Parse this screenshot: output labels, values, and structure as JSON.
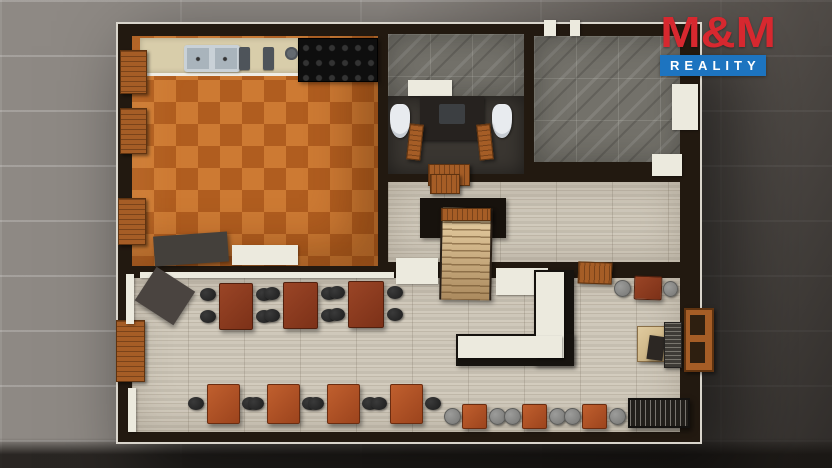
{
  "brand": {
    "name": "M&M",
    "tagline": "REALITY",
    "red": "#d7282f",
    "blue": "#1d74c0"
  },
  "scene": {
    "description": "3D top-down floor plan render of a restaurant: kitchen with orange tile, washrooms, marble storage room, hallway with staircase, dining room with bar",
    "palette": {
      "pavement": "#8e8984",
      "wall": "#221910",
      "kitchen_tile": "#c06c2a",
      "wood_floor": "#c9c2b3",
      "marble_floor": "#73716a",
      "wc_floor": "#3a3631",
      "counter_beige": "#d8cdaa",
      "table_wood": "#8c3c22",
      "table_orange": "#b4542a",
      "chair_dark": "#262525",
      "chair_gray": "#8f8f8d",
      "bar_top": "#eceade",
      "wood_shutter": "#a55d26"
    },
    "rooms": [
      {
        "name": "kitchen-floor",
        "cls": "floor-kitchen",
        "x": 132,
        "y": 36,
        "w": 246,
        "h": 230
      },
      {
        "name": "washroom-wall-tiles",
        "cls": "floor-marble",
        "x": 388,
        "y": 34,
        "w": 136,
        "h": 62
      },
      {
        "name": "washroom-floor",
        "cls": "floor-dark",
        "x": 388,
        "y": 96,
        "w": 136,
        "h": 78
      },
      {
        "name": "storage-room-floor",
        "cls": "floor-marble",
        "x": 534,
        "y": 36,
        "w": 146,
        "h": 126
      },
      {
        "name": "hallway-floor",
        "cls": "floor-wood",
        "x": 388,
        "y": 182,
        "w": 292,
        "h": 80
      },
      {
        "name": "dining-room-floor",
        "cls": "floor-wood",
        "x": 132,
        "y": 278,
        "w": 548,
        "h": 154
      }
    ],
    "furniture": [
      {
        "name": "kitchen-counter",
        "cls": "counter",
        "x": 140,
        "y": 38,
        "w": 238,
        "h": 38
      },
      {
        "name": "double-sink",
        "cls": "sink",
        "x": 184,
        "y": 45,
        "w": 56,
        "h": 27
      },
      {
        "name": "faucet",
        "cls": "fixture",
        "x": 239,
        "y": 47,
        "w": 11,
        "h": 23
      },
      {
        "name": "faucet",
        "cls": "fixture",
        "x": 263,
        "y": 47,
        "w": 11,
        "h": 23
      },
      {
        "name": "hot-plate",
        "cls": "round-fixture",
        "x": 285,
        "y": 47,
        "w": 13,
        "h": 13
      },
      {
        "name": "stove-range",
        "cls": "stove",
        "x": 298,
        "y": 38,
        "w": 80,
        "h": 44
      },
      {
        "name": "kitchen-cabinet-dark",
        "cls": "dark-box",
        "color": "#44403b",
        "x": 154,
        "y": 234,
        "w": 74,
        "h": 30,
        "rot": -4
      },
      {
        "name": "chest-freezer",
        "cls": "white-box",
        "x": 232,
        "y": 245,
        "w": 66,
        "h": 20
      },
      {
        "name": "wall-ledge",
        "cls": "white-box",
        "x": 140,
        "y": 272,
        "w": 254,
        "h": 6
      },
      {
        "name": "wc-window-frame",
        "cls": "white-box",
        "x": 408,
        "y": 80,
        "w": 44,
        "h": 16
      },
      {
        "name": "toilet",
        "cls": "toilet",
        "x": 390,
        "y": 104,
        "w": 20,
        "h": 34
      },
      {
        "name": "toilet",
        "cls": "toilet",
        "x": 492,
        "y": 104,
        "w": 20,
        "h": 34
      },
      {
        "name": "washbasin-vanity",
        "cls": "vanity",
        "x": 420,
        "y": 96,
        "w": 64,
        "h": 44
      },
      {
        "name": "wc-stall-door",
        "cls": "shutter",
        "x": 408,
        "y": 124,
        "w": 14,
        "h": 36,
        "rot": 6
      },
      {
        "name": "wc-stall-door",
        "cls": "shutter",
        "x": 478,
        "y": 124,
        "w": 14,
        "h": 36,
        "rot": -6
      },
      {
        "name": "wc-entrance-door",
        "cls": "shutter-h",
        "x": 428,
        "y": 164,
        "w": 42,
        "h": 22
      },
      {
        "name": "window-frame",
        "cls": "white-box",
        "x": 672,
        "y": 84,
        "w": 26,
        "h": 46
      },
      {
        "name": "door-frame",
        "cls": "white-box",
        "x": 652,
        "y": 154,
        "w": 30,
        "h": 22
      },
      {
        "name": "wall-post",
        "cls": "white-box",
        "x": 544,
        "y": 20,
        "w": 12,
        "h": 16
      },
      {
        "name": "wall-post",
        "cls": "white-box",
        "x": 570,
        "y": 20,
        "w": 10,
        "h": 16
      },
      {
        "name": "hall-bench",
        "cls": "shutter-h",
        "x": 430,
        "y": 174,
        "w": 30,
        "h": 20
      },
      {
        "name": "stairwell",
        "cls": "dark-box",
        "color": "#17120d",
        "x": 420,
        "y": 198,
        "w": 86,
        "h": 40
      },
      {
        "name": "staircase",
        "cls": "stairs",
        "x": 440,
        "y": 208,
        "w": 52,
        "h": 92,
        "rot": 1
      },
      {
        "name": "stair-landing",
        "cls": "shutter-h",
        "x": 441,
        "y": 208,
        "w": 50,
        "h": 13
      },
      {
        "name": "stair-sidewall",
        "cls": "white-box",
        "x": 396,
        "y": 258,
        "w": 42,
        "h": 26
      },
      {
        "name": "bar-back-cabinet",
        "cls": "white-box",
        "x": 496,
        "y": 268,
        "w": 52,
        "h": 27
      },
      {
        "name": "hall-chair",
        "cls": "shutter-h",
        "x": 578,
        "y": 262,
        "w": 34,
        "h": 22,
        "rot": 2
      },
      {
        "name": "hall-table",
        "cls": "wood-table",
        "x": 634,
        "y": 276,
        "w": 28,
        "h": 24,
        "rot": 2
      },
      {
        "name": "armchair",
        "cls": "chair-gray",
        "x": 614,
        "y": 280,
        "w": 17,
        "h": 17
      },
      {
        "name": "armchair",
        "cls": "chair-gray",
        "x": 663,
        "y": 281,
        "w": 15,
        "h": 16
      },
      {
        "name": "dining-table",
        "cls": "wood-table",
        "x": 219,
        "y": 283,
        "w": 34,
        "h": 47
      },
      {
        "name": "chair",
        "cls": "chair-black",
        "x": 200,
        "y": 288,
        "w": 16,
        "h": 13
      },
      {
        "name": "chair",
        "cls": "chair-black",
        "x": 200,
        "y": 310,
        "w": 16,
        "h": 13
      },
      {
        "name": "chair",
        "cls": "chair-black",
        "x": 256,
        "y": 288,
        "w": 16,
        "h": 13
      },
      {
        "name": "chair",
        "cls": "chair-black",
        "x": 256,
        "y": 310,
        "w": 16,
        "h": 13
      },
      {
        "name": "dining-table",
        "cls": "wood-table",
        "x": 283,
        "y": 282,
        "w": 35,
        "h": 47
      },
      {
        "name": "chair",
        "cls": "chair-black",
        "x": 264,
        "y": 287,
        "w": 16,
        "h": 13
      },
      {
        "name": "chair",
        "cls": "chair-black",
        "x": 264,
        "y": 309,
        "w": 16,
        "h": 13
      },
      {
        "name": "chair",
        "cls": "chair-black",
        "x": 321,
        "y": 287,
        "w": 16,
        "h": 13
      },
      {
        "name": "chair",
        "cls": "chair-black",
        "x": 321,
        "y": 309,
        "w": 16,
        "h": 13
      },
      {
        "name": "dining-table",
        "cls": "wood-table",
        "x": 348,
        "y": 281,
        "w": 36,
        "h": 47
      },
      {
        "name": "chair",
        "cls": "chair-black",
        "x": 329,
        "y": 286,
        "w": 16,
        "h": 13
      },
      {
        "name": "chair",
        "cls": "chair-black",
        "x": 329,
        "y": 308,
        "w": 16,
        "h": 13
      },
      {
        "name": "chair",
        "cls": "chair-black",
        "x": 387,
        "y": 286,
        "w": 16,
        "h": 13
      },
      {
        "name": "chair",
        "cls": "chair-black",
        "x": 387,
        "y": 308,
        "w": 16,
        "h": 13
      },
      {
        "name": "bistro-table",
        "cls": "sq-table",
        "x": 207,
        "y": 384,
        "w": 33,
        "h": 40
      },
      {
        "name": "chair",
        "cls": "chair-black",
        "x": 188,
        "y": 397,
        "w": 16,
        "h": 13
      },
      {
        "name": "chair",
        "cls": "chair-black",
        "x": 242,
        "y": 397,
        "w": 16,
        "h": 13
      },
      {
        "name": "bistro-table",
        "cls": "sq-table",
        "x": 267,
        "y": 384,
        "w": 33,
        "h": 40
      },
      {
        "name": "chair",
        "cls": "chair-black",
        "x": 248,
        "y": 397,
        "w": 16,
        "h": 13
      },
      {
        "name": "chair",
        "cls": "chair-black",
        "x": 302,
        "y": 397,
        "w": 16,
        "h": 13
      },
      {
        "name": "bistro-table",
        "cls": "sq-table",
        "x": 327,
        "y": 384,
        "w": 33,
        "h": 40
      },
      {
        "name": "chair",
        "cls": "chair-black",
        "x": 308,
        "y": 397,
        "w": 16,
        "h": 13
      },
      {
        "name": "chair",
        "cls": "chair-black",
        "x": 362,
        "y": 397,
        "w": 16,
        "h": 13
      },
      {
        "name": "bistro-table",
        "cls": "sq-table",
        "x": 390,
        "y": 384,
        "w": 33,
        "h": 40
      },
      {
        "name": "chair",
        "cls": "chair-black",
        "x": 371,
        "y": 397,
        "w": 16,
        "h": 13
      },
      {
        "name": "chair",
        "cls": "chair-black",
        "x": 425,
        "y": 397,
        "w": 16,
        "h": 13
      },
      {
        "name": "service-station",
        "cls": "dark-box",
        "color": "#4a4440",
        "x": 142,
        "y": 276,
        "w": 46,
        "h": 40,
        "rot": 33
      },
      {
        "name": "bar-counter-base",
        "cls": "dark-box",
        "color": "#16130f",
        "x": 534,
        "y": 270,
        "w": 40,
        "h": 96
      },
      {
        "name": "bar-counter-base",
        "cls": "dark-box",
        "color": "#16130f",
        "x": 456,
        "y": 334,
        "w": 118,
        "h": 32
      },
      {
        "name": "bar-counter-top",
        "cls": "white-box",
        "x": 536,
        "y": 272,
        "w": 28,
        "h": 86
      },
      {
        "name": "bar-counter-top",
        "cls": "white-box",
        "x": 458,
        "y": 336,
        "w": 104,
        "h": 22
      },
      {
        "name": "cafe-table",
        "cls": "sq-table",
        "x": 462,
        "y": 404,
        "w": 25,
        "h": 25
      },
      {
        "name": "armchair",
        "cls": "chair-gray",
        "x": 444,
        "y": 408,
        "w": 17,
        "h": 17
      },
      {
        "name": "armchair",
        "cls": "chair-gray",
        "x": 489,
        "y": 408,
        "w": 17,
        "h": 17
      },
      {
        "name": "cafe-table",
        "cls": "sq-table",
        "x": 522,
        "y": 404,
        "w": 25,
        "h": 25
      },
      {
        "name": "armchair",
        "cls": "chair-gray",
        "x": 504,
        "y": 408,
        "w": 17,
        "h": 17
      },
      {
        "name": "armchair",
        "cls": "chair-gray",
        "x": 549,
        "y": 408,
        "w": 17,
        "h": 17
      },
      {
        "name": "cafe-table",
        "cls": "sq-table",
        "x": 582,
        "y": 404,
        "w": 25,
        "h": 25
      },
      {
        "name": "armchair",
        "cls": "chair-gray",
        "x": 564,
        "y": 408,
        "w": 17,
        "h": 17
      },
      {
        "name": "armchair",
        "cls": "chair-gray",
        "x": 609,
        "y": 408,
        "w": 17,
        "h": 17
      },
      {
        "name": "desk",
        "cls": "desk",
        "x": 637,
        "y": 326,
        "w": 28,
        "h": 36
      },
      {
        "name": "desk-chair",
        "cls": "dark-box",
        "color": "#2c2723",
        "x": 648,
        "y": 336,
        "w": 16,
        "h": 24,
        "rot": 8
      },
      {
        "name": "radiator-bench",
        "cls": "radiator",
        "x": 664,
        "y": 322,
        "w": 18,
        "h": 46
      },
      {
        "name": "bench",
        "cls": "bench",
        "x": 628,
        "y": 398,
        "w": 62,
        "h": 30
      },
      {
        "name": "window-shutter",
        "cls": "shutter-frame",
        "x": 684,
        "y": 308,
        "w": 30,
        "h": 64
      },
      {
        "name": "window-shutter",
        "cls": "shutter",
        "x": 120,
        "y": 50,
        "w": 27,
        "h": 44
      },
      {
        "name": "window-shutter",
        "cls": "shutter",
        "x": 120,
        "y": 108,
        "w": 27,
        "h": 46
      },
      {
        "name": "window-shutter",
        "cls": "shutter",
        "x": 118,
        "y": 198,
        "w": 28,
        "h": 47
      },
      {
        "name": "window-shutter",
        "cls": "shutter",
        "x": 116,
        "y": 320,
        "w": 29,
        "h": 62
      },
      {
        "name": "wall-window",
        "cls": "white-box",
        "x": 126,
        "y": 274,
        "w": 8,
        "h": 50
      },
      {
        "name": "wall-window",
        "cls": "white-box",
        "x": 128,
        "y": 388,
        "w": 8,
        "h": 44
      }
    ]
  }
}
